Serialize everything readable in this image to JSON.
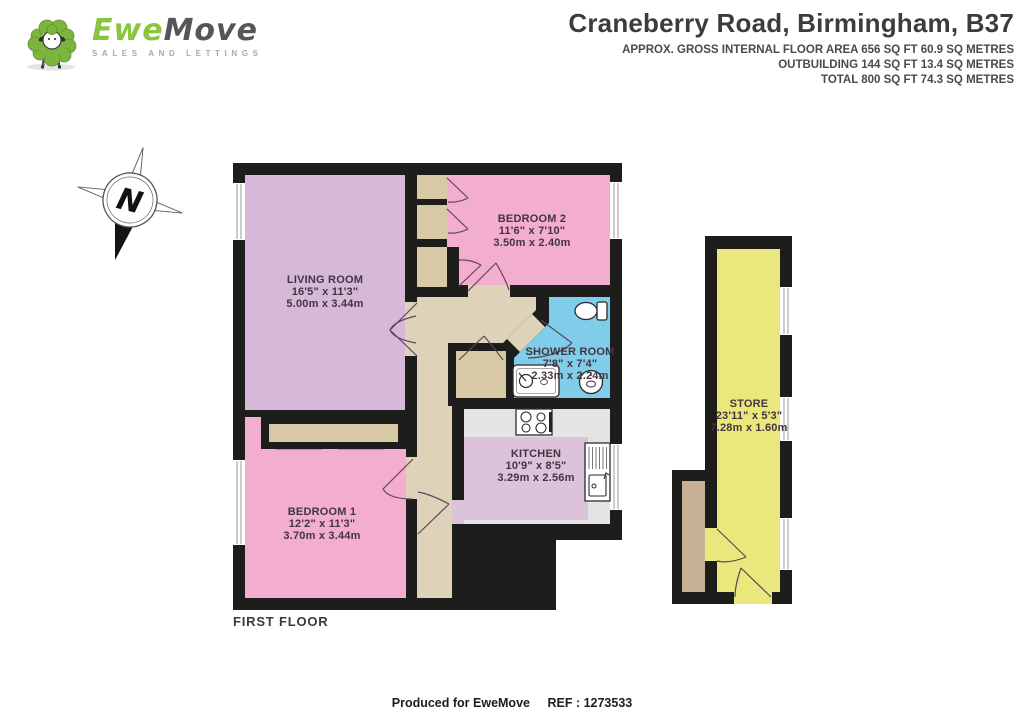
{
  "header": {
    "logo": {
      "brand_ewe": "Ewe",
      "brand_move": "Move",
      "tagline": "SALES AND LETTINGS"
    },
    "title": "Craneberry Road, Birmingham, B37",
    "area_lines": [
      "APPROX. GROSS INTERNAL FLOOR AREA 656 SQ FT 60.9 SQ METRES",
      "OUTBUILDING 144 SQ FT 13.4 SQ METRES",
      "TOTAL 800 SQ FT 74.3 SQ METRES"
    ]
  },
  "compass": {
    "label": "N"
  },
  "floor_label": "FIRST FLOOR",
  "rooms": {
    "living_room": {
      "name": "LIVING ROOM",
      "imperial": "16'5\" x 11'3\"",
      "metric": "5.00m x 3.44m",
      "color": "#d6b8d8"
    },
    "bedroom_2": {
      "name": "BEDROOM 2",
      "imperial": "11'6\" x 7'10\"",
      "metric": "3.50m x 2.40m",
      "color": "#f3adcf"
    },
    "shower_room": {
      "name": "SHOWER ROOM",
      "imperial": "7'8\" x 7'4\"",
      "metric": "2.33m x 2.24m",
      "color": "#80cde9"
    },
    "kitchen": {
      "name": "KITCHEN",
      "imperial": "10'9\" x 8'5\"",
      "metric": "3.29m x 2.56m",
      "color": "#e4e4e6"
    },
    "bedroom_1": {
      "name": "BEDROOM 1",
      "imperial": "12'2\" x 11'3\"",
      "metric": "3.70m x 3.44m",
      "color": "#f3adcf"
    },
    "store": {
      "name": "STORE",
      "imperial": "23'11\" x 5'3\"",
      "metric": "7.28m x 1.60m",
      "color": "#eae87d"
    }
  },
  "palette": {
    "wall": "#1d1d1b",
    "hall": "#ded3b8",
    "closet": "#d8c9a6",
    "kitchen_floor": "#dcc2da",
    "porch": "#c7b295",
    "brand_green": "#8bc53f"
  },
  "footer": {
    "produced": "Produced for EweMove",
    "ref": "REF : 1273533"
  }
}
